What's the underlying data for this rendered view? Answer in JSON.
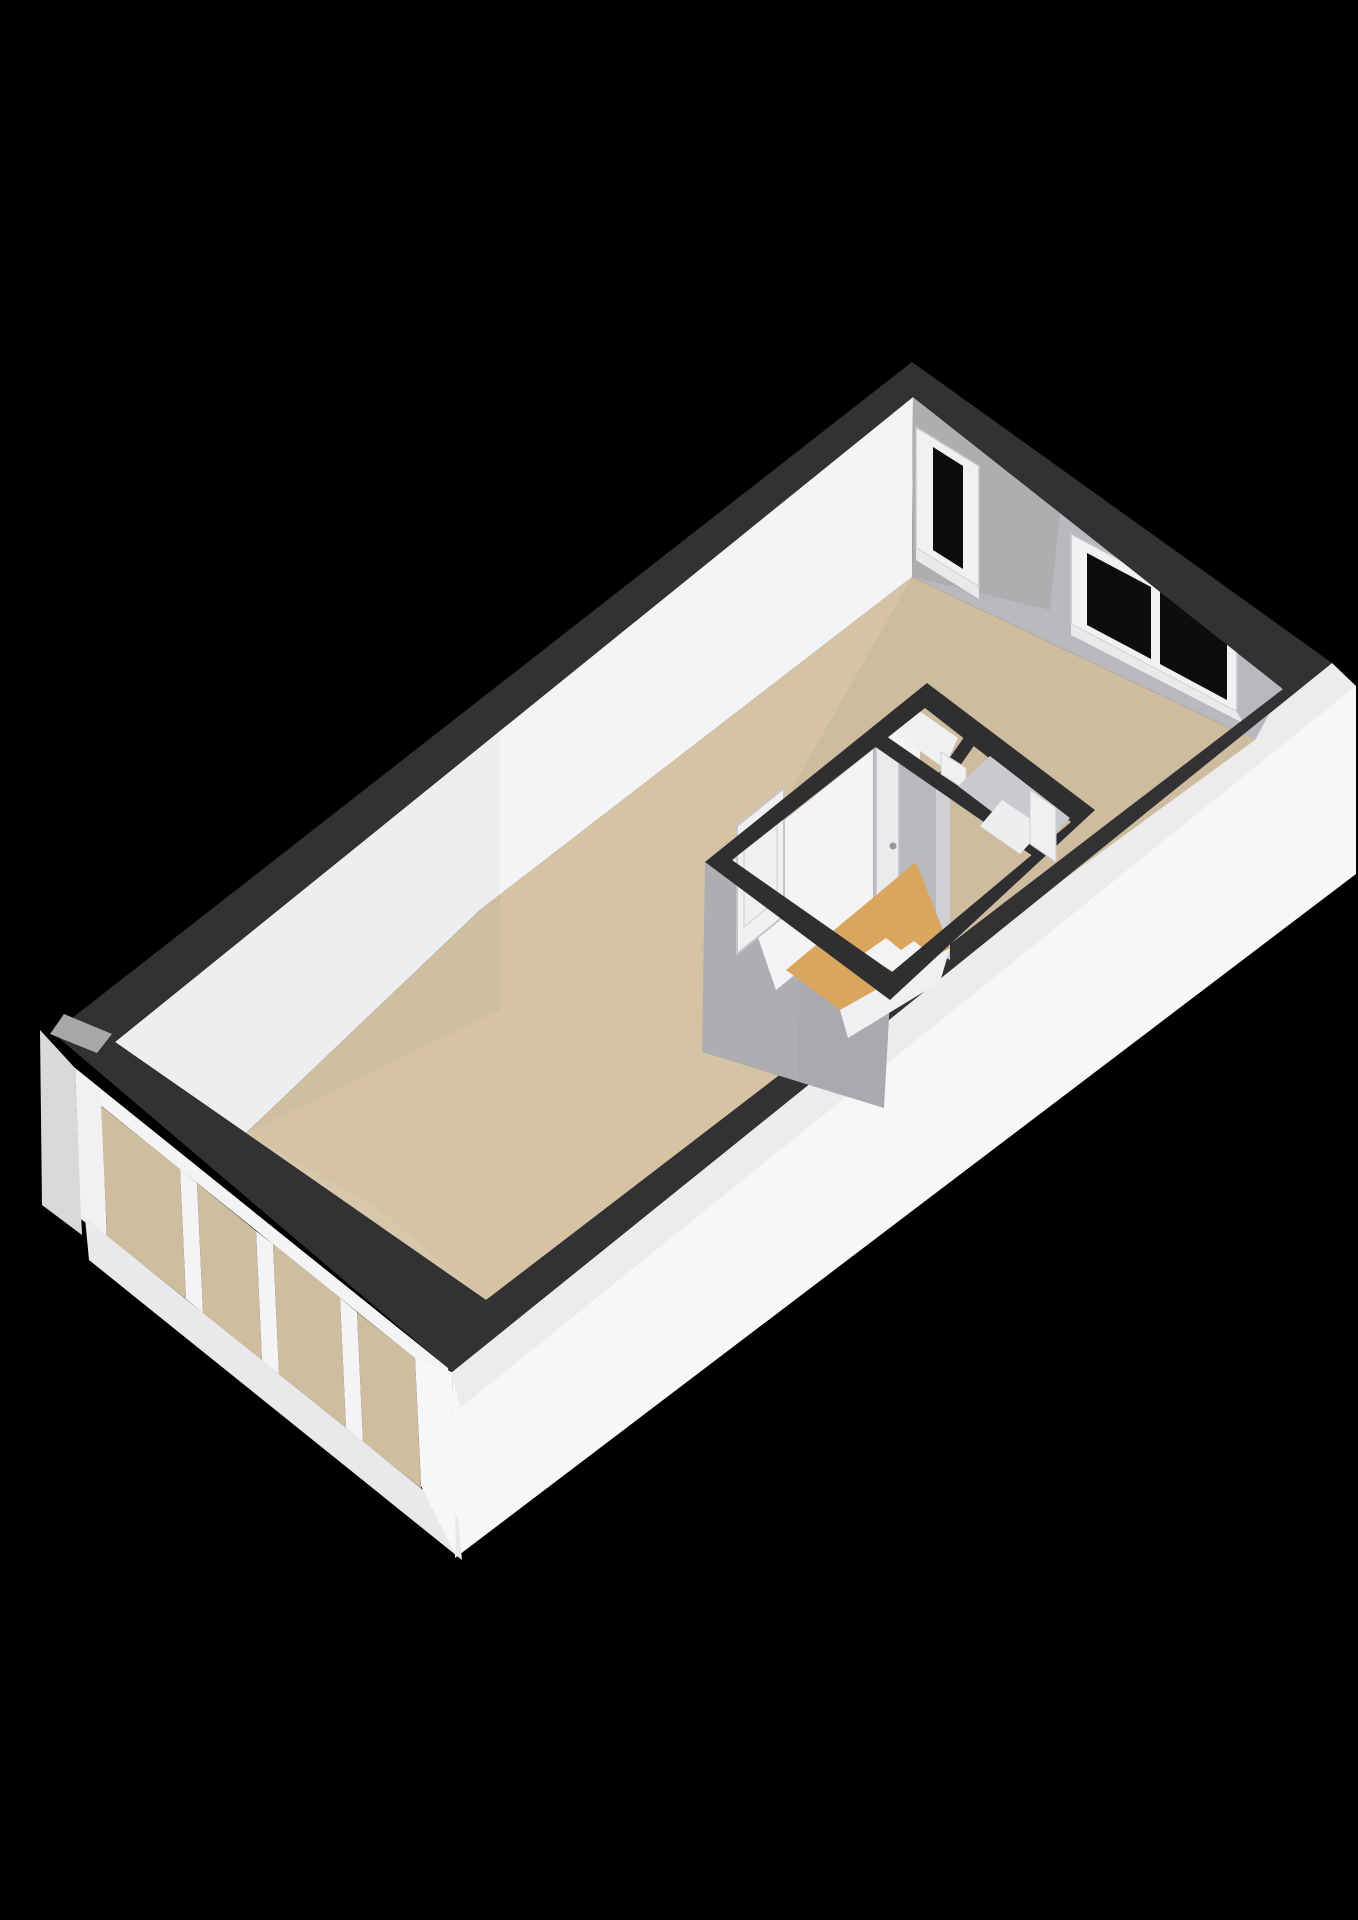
{
  "scene": {
    "type": "3d-floor-plan-render",
    "description": "Isometric 3D floor plan of a single large room (studio) viewed from above on a black background, with an interior bathroom block, a glazed wall of four glass panels on the lower-left side, a narrow window and a wide two-pane window on the upper-right wall",
    "rooms": [
      {
        "name": "main-room",
        "floor": "beige"
      },
      {
        "name": "bathroom",
        "floor": "ochre"
      },
      {
        "name": "closet-nook",
        "floor": "white"
      },
      {
        "name": "second-small-room",
        "floor": "white"
      }
    ],
    "window_count": 2,
    "glass_panel_count": 4,
    "interior_door_count": 3
  },
  "palette": {
    "background": "#000000",
    "wall_top": "#323235",
    "wall_top_inner": "#2f2f32",
    "exterior_white": "#f7f7f9",
    "exterior_white_shade": "#ededf0",
    "interior_white_wall": "#f4f4f6",
    "interior_gray_wall": "#b9b9bd",
    "gray_wall_light": "#ced0d3",
    "floor_main": "#d6c3a4",
    "floor_glass_tint": "#cfbda0",
    "floor_bathroom": "#d9a55f",
    "fixture_white": "#f3f3f5",
    "window_glass": "#0d0d0f",
    "window_frame": "#f1f1f3",
    "window_sill": "#e9e9ec",
    "mullion_white": "#f4f4f6",
    "complex_gray_face": "#aaaaae",
    "door_white": "#f0f0f2",
    "door_leaf": "#e9eaec",
    "door_handle": "#97979b",
    "corner_patch": "#a8a8aa",
    "left_return": "#d9d9dc",
    "nook_floor": "#eff0f2",
    "room2_base": "#c9cace",
    "room2_floor": "#ecedef",
    "white_strip": "#eef0f1"
  }
}
